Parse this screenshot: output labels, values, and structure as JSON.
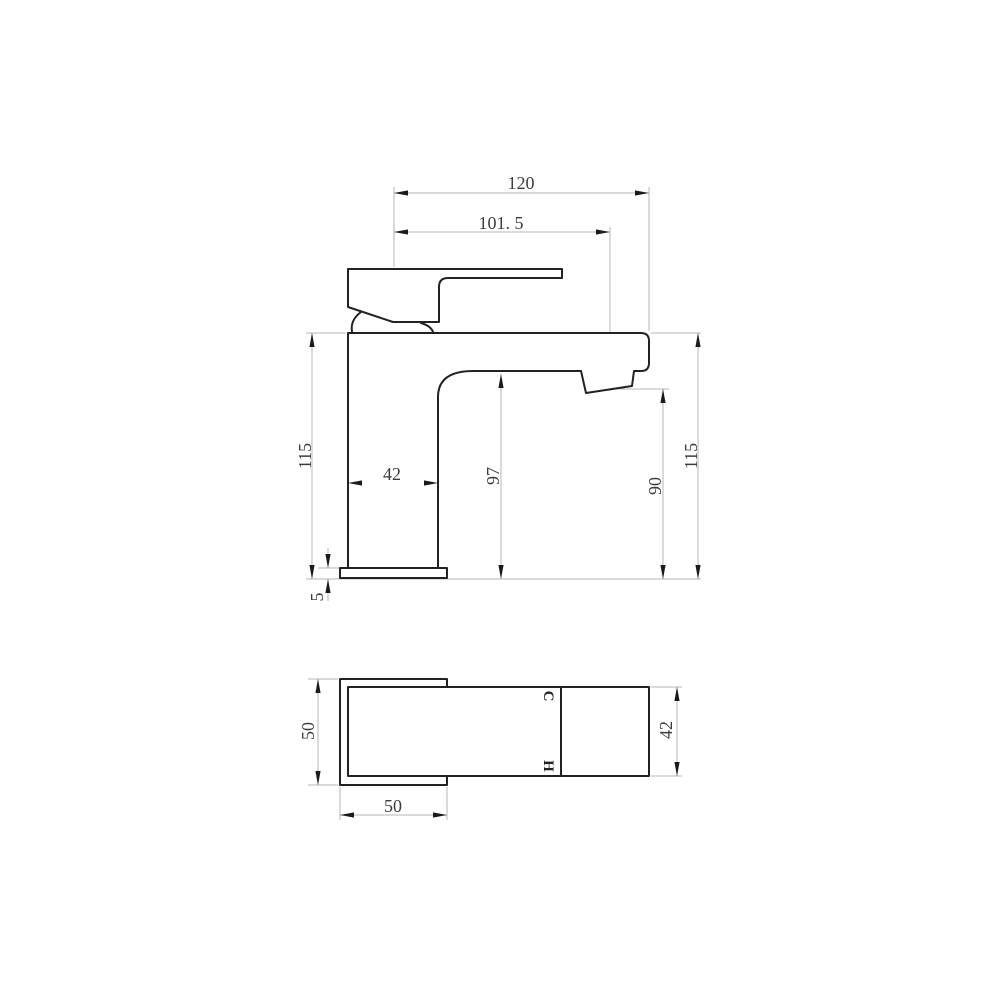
{
  "drawing": {
    "colors": {
      "outline": "#222222",
      "dimension_line": "#b4b4b4",
      "arrow": "#1a1a1a",
      "text": "#3c3c3c"
    },
    "side_view": {
      "dim_overall_width": "120",
      "dim_spout_reach": "101. 5",
      "dim_height_left": "115",
      "dim_body_width": "42",
      "dim_underspout_height": "97",
      "dim_outlet_height": "90",
      "dim_height_right": "115",
      "dim_base_thickness": "5"
    },
    "plan_view": {
      "dim_base_depth": "50",
      "dim_base_width": "50",
      "dim_body_depth": "42",
      "label_cold": "C",
      "label_hot": "H"
    }
  }
}
